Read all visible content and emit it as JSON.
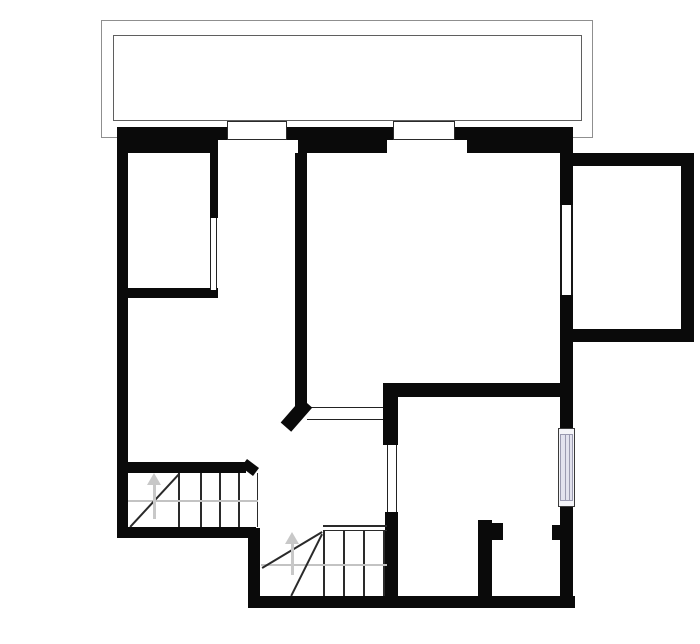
{
  "canvas": {
    "width": 700,
    "height": 644,
    "background": "#ffffff"
  },
  "colors": {
    "wall": "#0a0a0a",
    "thin_line": "#222222",
    "gray_guide": "#c3c3c3",
    "balcony_outer": "#8f8f8f",
    "balcony_inner": "#5f5f5f",
    "window_glass": "#e2e2ee",
    "window_frame": "#9a9ab0"
  },
  "plan": {
    "rects": [
      {
        "name": "balcony-outer-rail",
        "x": 101,
        "y": 20,
        "w": 492,
        "h": 118,
        "border": "1px solid #8f8f8f"
      },
      {
        "name": "balcony-inner-rail",
        "x": 113,
        "y": 35,
        "w": 469,
        "h": 86,
        "border": "1px solid #5f5f5f"
      },
      {
        "name": "wall-exterior-left",
        "x": 117,
        "y": 128,
        "w": 11,
        "h": 410,
        "fill": "#0a0a0a"
      },
      {
        "name": "wall-exterior-top",
        "x": 117,
        "y": 127,
        "w": 456,
        "h": 26,
        "fill": "#0a0a0a"
      },
      {
        "name": "wall-exterior-right-upper",
        "x": 560,
        "y": 140,
        "w": 13,
        "h": 65,
        "fill": "#0a0a0a"
      },
      {
        "name": "wall-exterior-right-middle",
        "x": 560,
        "y": 295,
        "w": 13,
        "h": 133,
        "fill": "#0a0a0a"
      },
      {
        "name": "wall-exterior-right-lower",
        "x": 560,
        "y": 507,
        "w": 13,
        "h": 101,
        "fill": "#0a0a0a"
      },
      {
        "name": "wall-room1-side",
        "x": 210,
        "y": 152,
        "w": 8,
        "h": 66,
        "fill": "#0a0a0a"
      },
      {
        "name": "wall-room1-bottom",
        "x": 117,
        "y": 288,
        "w": 101,
        "h": 10,
        "fill": "#0a0a0a"
      },
      {
        "name": "wall-central-vertical",
        "x": 295,
        "y": 152,
        "w": 12,
        "h": 256,
        "fill": "#0a0a0a"
      },
      {
        "name": "wall-middle-horizontal",
        "x": 383,
        "y": 383,
        "w": 190,
        "h": 14,
        "fill": "#0a0a0a"
      },
      {
        "name": "wall-hall-door-jamb-upper",
        "x": 383,
        "y": 383,
        "w": 15,
        "h": 62,
        "fill": "#0a0a0a"
      },
      {
        "name": "wall-hall-door-jamb-lower",
        "x": 385,
        "y": 512,
        "w": 13,
        "h": 96,
        "fill": "#0a0a0a"
      },
      {
        "name": "wall-exterior-bottom",
        "x": 248,
        "y": 596,
        "w": 327,
        "h": 12,
        "fill": "#0a0a0a"
      },
      {
        "name": "wall-step-down",
        "x": 248,
        "y": 528,
        "w": 12,
        "h": 80,
        "fill": "#0a0a0a"
      },
      {
        "name": "wall-stair1-bottom",
        "x": 117,
        "y": 527,
        "w": 139,
        "h": 11,
        "fill": "#0a0a0a"
      },
      {
        "name": "wall-stair1-top",
        "x": 128,
        "y": 462,
        "w": 118,
        "h": 11,
        "fill": "#0a0a0a"
      },
      {
        "name": "wall-small-room-left",
        "x": 478,
        "y": 520,
        "w": 14,
        "h": 88,
        "fill": "#0a0a0a"
      },
      {
        "name": "wall-small-room-notch-left",
        "x": 492,
        "y": 523,
        "w": 11,
        "h": 17,
        "fill": "#0a0a0a"
      },
      {
        "name": "wall-small-room-notch-right",
        "x": 552,
        "y": 525,
        "w": 8,
        "h": 15,
        "fill": "#0a0a0a"
      },
      {
        "name": "wall-annex-top",
        "x": 573,
        "y": 153,
        "w": 121,
        "h": 13,
        "fill": "#0a0a0a"
      },
      {
        "name": "wall-annex-right",
        "x": 681,
        "y": 153,
        "w": 13,
        "h": 189,
        "fill": "#0a0a0a"
      },
      {
        "name": "wall-annex-bottom",
        "x": 573,
        "y": 329,
        "w": 121,
        "h": 13,
        "fill": "#0a0a0a"
      },
      {
        "name": "window1-inner-reveal",
        "x": 218,
        "y": 140,
        "w": 80,
        "h": 13,
        "fill": "#ffffff"
      },
      {
        "name": "window2-inner-reveal",
        "x": 387,
        "y": 140,
        "w": 80,
        "h": 13,
        "fill": "#ffffff"
      },
      {
        "name": "top-window-1",
        "x": 227,
        "y": 121,
        "w": 60,
        "h": 19,
        "fill": "#ffffff",
        "border": "1.5px solid #2a2a2a"
      },
      {
        "name": "top-window-2",
        "x": 393,
        "y": 121,
        "w": 62,
        "h": 19,
        "fill": "#ffffff",
        "border": "1.5px solid #2a2a2a"
      },
      {
        "name": "right-window-upper",
        "x": 560,
        "y": 205,
        "w": 13,
        "h": 90,
        "fill": "#ffffff",
        "bl": "2px solid #161616",
        "br": "2px solid #161616"
      },
      {
        "name": "right-window-lower-frame",
        "x": 558,
        "y": 428,
        "w": 17,
        "h": 79,
        "fill": "#f4f4f8",
        "border": "1.5px solid #3a3a3a"
      },
      {
        "name": "right-window-lower-glass",
        "x": 560,
        "y": 434,
        "w": 13,
        "h": 67,
        "fill": "#e2e2ee",
        "border": "1px solid #9a9ab0"
      },
      {
        "name": "right-window-lower-mullion-1",
        "x": 564.5,
        "y": 434,
        "w": 1,
        "h": 67,
        "fill": "#9a9ab0"
      },
      {
        "name": "right-window-lower-mullion-2",
        "x": 569,
        "y": 434,
        "w": 1,
        "h": 67,
        "fill": "#9a9ab0"
      },
      {
        "name": "room1-door-opening",
        "x": 210,
        "y": 218,
        "w": 7,
        "h": 72,
        "fill": "#ffffff",
        "bl": "1.5px solid #222222",
        "br": "1.5px solid #222222"
      },
      {
        "name": "hall-door-opening",
        "x": 387,
        "y": 445,
        "w": 10,
        "h": 67,
        "fill": "#ffffff",
        "bl": "1.5px solid #222222",
        "br": "1.5px solid #222222"
      },
      {
        "name": "passage-threshold",
        "x": 307,
        "y": 407,
        "w": 76,
        "h": 13,
        "fill": "#ffffff",
        "bt": "1.5px solid #222222",
        "bb": "1.5px solid #222222"
      },
      {
        "name": "stair1-tread-1",
        "x": 178,
        "y": 473,
        "w": 1.5,
        "h": 54,
        "fill": "#2a2a2a"
      },
      {
        "name": "stair1-tread-2",
        "x": 200,
        "y": 473,
        "w": 1.5,
        "h": 54,
        "fill": "#2a2a2a"
      },
      {
        "name": "stair1-tread-3",
        "x": 219,
        "y": 473,
        "w": 1.5,
        "h": 54,
        "fill": "#2a2a2a"
      },
      {
        "name": "stair1-tread-4",
        "x": 238,
        "y": 473,
        "w": 1.5,
        "h": 54,
        "fill": "#2a2a2a"
      },
      {
        "name": "stair1-edge",
        "x": 256.5,
        "y": 473,
        "w": 1.5,
        "h": 54,
        "fill": "#2a2a2a"
      },
      {
        "name": "stair1-walkline",
        "x": 128,
        "y": 500,
        "w": 130,
        "h": 1.5,
        "fill": "#c3c3c3"
      },
      {
        "name": "stair2-landing-line-1",
        "x": 323,
        "y": 525,
        "w": 64,
        "h": 1.5,
        "fill": "#2a2a2a"
      },
      {
        "name": "stair2-landing-line-2",
        "x": 323,
        "y": 529.5,
        "w": 64,
        "h": 1.5,
        "fill": "#2a2a2a"
      },
      {
        "name": "stair2-tread-1",
        "x": 323,
        "y": 531,
        "w": 1.5,
        "h": 65,
        "fill": "#2a2a2a"
      },
      {
        "name": "stair2-tread-2",
        "x": 343,
        "y": 531,
        "w": 1.5,
        "h": 65,
        "fill": "#2a2a2a"
      },
      {
        "name": "stair2-tread-3",
        "x": 363,
        "y": 531,
        "w": 1.5,
        "h": 65,
        "fill": "#2a2a2a"
      },
      {
        "name": "stair2-tread-4",
        "x": 383,
        "y": 531,
        "w": 1.5,
        "h": 65,
        "fill": "#2a2a2a"
      },
      {
        "name": "stair2-walkline",
        "x": 261,
        "y": 564,
        "w": 126,
        "h": 1.5,
        "fill": "#c3c3c3"
      }
    ],
    "lines": [
      {
        "name": "stair1-winder-line",
        "x1": 130,
        "y1": 527,
        "x2": 179,
        "y2": 474,
        "t": 1.6,
        "color": "#2a2a2a"
      },
      {
        "name": "stair2-winder-line-1",
        "x1": 262,
        "y1": 568,
        "x2": 322,
        "y2": 532,
        "t": 1.6,
        "color": "#2a2a2a"
      },
      {
        "name": "stair2-winder-line-2",
        "x1": 291,
        "y1": 596,
        "x2": 322,
        "y2": 534,
        "t": 1.6,
        "color": "#2a2a2a"
      },
      {
        "name": "wall-central-chamfer-end",
        "x1": 307,
        "y1": 403,
        "x2": 286,
        "y2": 427,
        "t": 14,
        "color": "#0a0a0a"
      },
      {
        "name": "wall-stair1-top-bevel",
        "x1": 244,
        "y1": 463,
        "x2": 256,
        "y2": 472,
        "t": 10,
        "color": "#0a0a0a"
      }
    ],
    "arrows": [
      {
        "name": "stair1-up-arrow",
        "x": 154,
        "y": 473,
        "head_w": 7,
        "head_h": 12,
        "stem_w": 3,
        "stem_h": 35,
        "color": "#c8c8c8"
      },
      {
        "name": "stair2-up-arrow",
        "x": 292,
        "y": 532,
        "head_w": 7,
        "head_h": 12,
        "stem_w": 3,
        "stem_h": 32,
        "color": "#c8c8c8"
      }
    ]
  }
}
